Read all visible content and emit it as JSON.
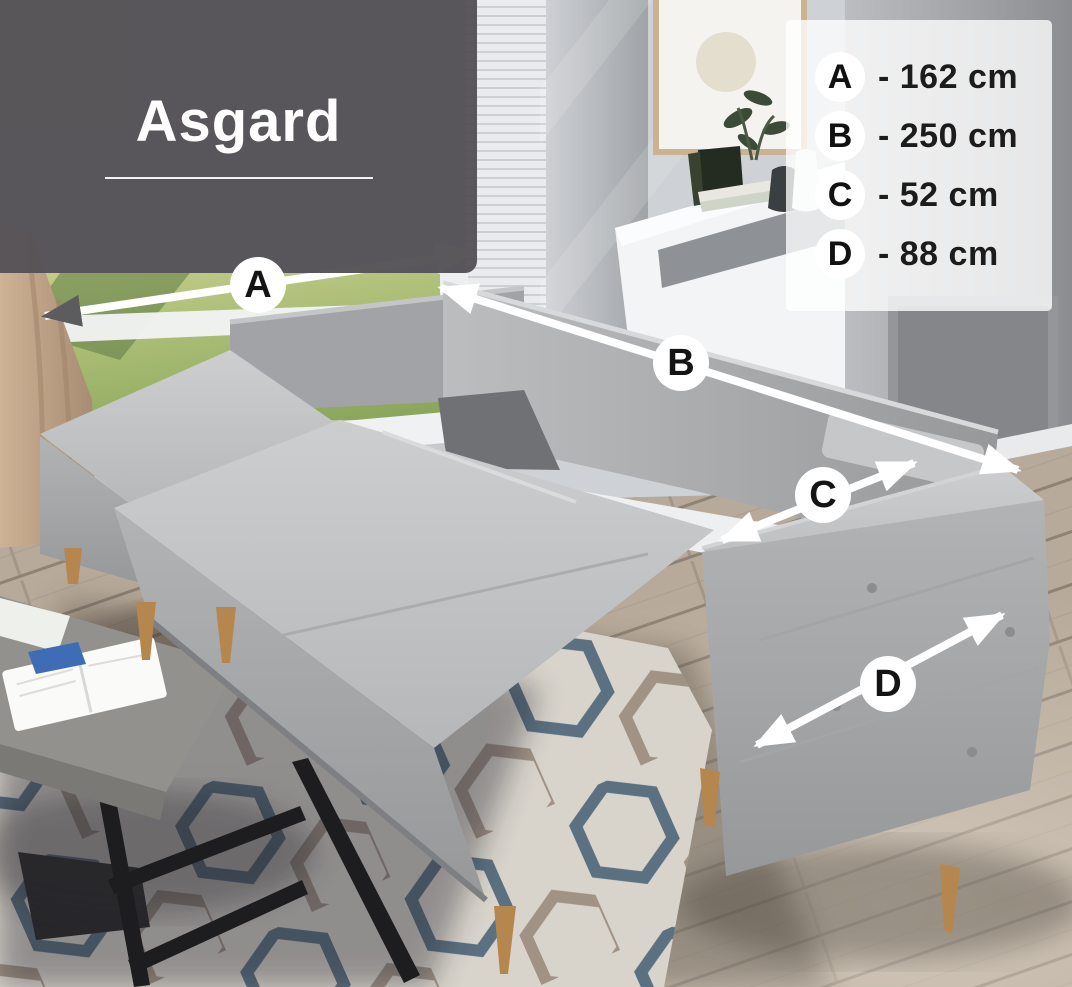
{
  "title": {
    "text": "Asgard"
  },
  "legend": {
    "items": [
      {
        "letter": "A",
        "value": "162 cm",
        "display": "- 162 cm"
      },
      {
        "letter": "B",
        "value": "250 cm",
        "display": "- 250 cm"
      },
      {
        "letter": "C",
        "value": "52 cm",
        "display": "- 52 cm"
      },
      {
        "letter": "D",
        "value": "88 cm",
        "display": "- 88 cm"
      }
    ]
  },
  "colors": {
    "title_panel_bg": "rgba(84,81,85,0.96)",
    "legend_bg": "rgba(255,255,255,0.78)",
    "arrow": "#ffffff",
    "arrow_gray": "#5c5c5e",
    "sofa_fabric_light": "#c9cacc",
    "sofa_fabric_shadow": "#98999b",
    "wood_leg": "#b5874f",
    "rug_blue": "#4d6578",
    "rug_taupe": "#9a8b7d",
    "grass_green": "#9fb56c",
    "floor_wood": "#b7aa9a"
  }
}
